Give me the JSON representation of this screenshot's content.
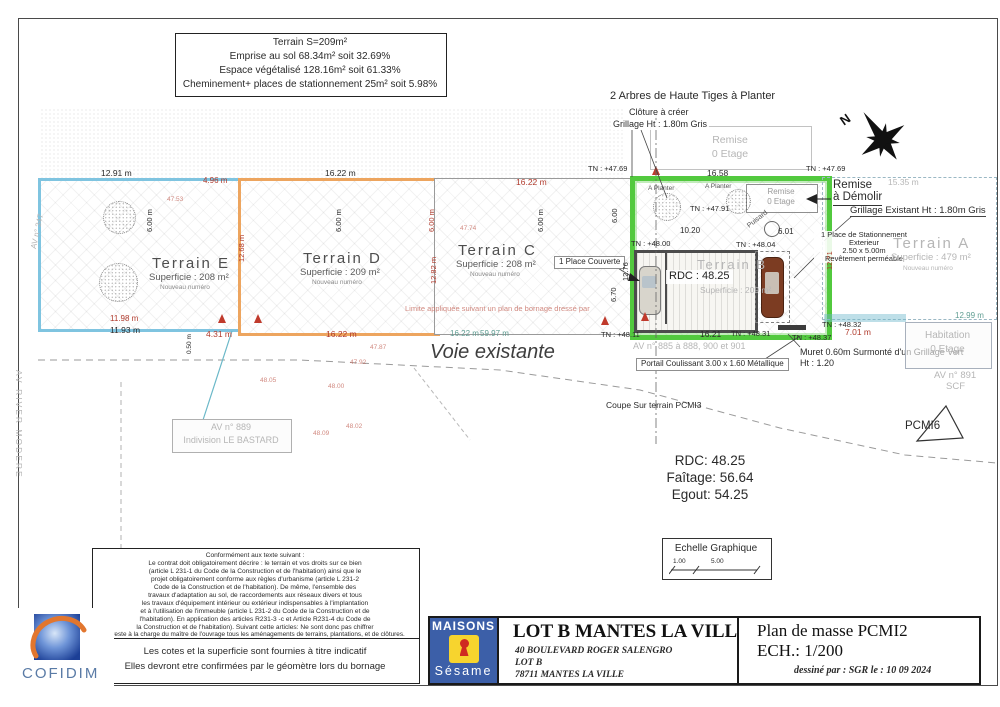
{
  "colors": {
    "lot_b_green": "#52c93e",
    "parcel_e_blue": "#7fc4e0",
    "parcel_d_orange": "#eda55f",
    "marker_red": "#c03a2c",
    "maisons_blue": "#3c5fa8",
    "maisons_yellow": "#f7d42e",
    "keyhole_red": "#cf2a21",
    "cofidim_orange": "#e2762e"
  },
  "stats_box": {
    "lines": [
      "Terrain S=209m²",
      "Emprise au sol 68.34m² soit 32.69%",
      "Espace végétalisé 128.16m² soit  61.33%",
      "Cheminement+ places de stationnement 25m² soit  5.98%"
    ]
  },
  "compass": {
    "label": "N"
  },
  "plan": {
    "terrains": {
      "e": {
        "name": "Terrain E",
        "area": "Superficie : 208 m²",
        "note": "Nouveau numéro"
      },
      "d": {
        "name": "Terrain D",
        "area": "Superficie : 209 m²",
        "note": "Nouveau numéro"
      },
      "c": {
        "name": "Terrain C",
        "area": "Superficie : 208 m²",
        "note": "Nouveau numéro"
      },
      "b": {
        "name": "Terrain B",
        "area": "Superficie : 209 m²",
        "rdc": "RDC : 48.25"
      },
      "a": {
        "name": "Terrain A",
        "area": "Superficie : 479 m²",
        "note": "Nouveau numéro"
      }
    },
    "annotations": {
      "arbres": "2 Arbres de Haute Tiges à Planter",
      "cloture1": "Clôture à créer",
      "cloture2": "Grillage Ht : 1.80m Gris",
      "remise_haut": [
        "Remise",
        "0 Etage"
      ],
      "remise_lot": [
        "Remise",
        "0 Etage"
      ],
      "remise_demolir": [
        "Remise",
        "à Démolir"
      ],
      "grillage_existant": "Grillage Existant Ht : 1.80m Gris",
      "stationnement": [
        "1 Place de Stationnement",
        "Exterieur",
        "2.50 x 5.00m",
        "Revêtement perméable"
      ],
      "place_couverte": "1 Place Couverte",
      "portail": "Portail Coulissant 3.00 x 1.60 Métallique",
      "muret1": "Muret 0.60m Surmonté d'un Grillage Vert",
      "muret2": "Ht : 1.20",
      "coupe": "Coupe Sur terrain PCMI3",
      "pcmi6": "PCMI6",
      "voie": "Voie existante",
      "puisard": "Puisard",
      "a_planter": "A Planter",
      "habitation": [
        "Habitation",
        "0 Etage"
      ],
      "av889": [
        "AV n° 889",
        "Indivision LE BASTARD"
      ],
      "av885": "AV n° 885 à 888, 900 et 901",
      "av891": [
        "AV n° 891",
        "SCF"
      ],
      "av347": "AV n° 347",
      "river": "AV RIVER MODERE",
      "limite": "Limite appliquée suivant un plan de bornage dressé par"
    },
    "dims": {
      "e_top": "12.91 m",
      "e_topright": "4.96 m",
      "e_left": "6.00 m",
      "e_right": "12.68 m",
      "e_bottom_red": "11.98 m",
      "e_bottom": "11.93 m",
      "e_431": "4.31 m",
      "e_050": "0.50 m",
      "d_top": "16.22 m",
      "d_mid": "6.00 m",
      "d_right_a": "6.00 m",
      "d_right": "12.82 m",
      "d_bottom": "16.22 m",
      "c_top": "16.22 m",
      "c_mid": "6.00 m",
      "c_right_a": "6.00",
      "c_right": "12.76",
      "c_670": "6.70",
      "c_bottom": "16.22 m",
      "c_5997": "59.97 m",
      "b_top": "16.58",
      "b_1020": "10.20",
      "b_601": "6.01",
      "b_right": "12.71",
      "b_bottom": "16.21",
      "a_1535": "15.35 m",
      "a_701": "7.01 m",
      "a_1299": "12.99 m"
    },
    "tn": {
      "t4769l": "TN : +47.69",
      "t4769r": "TN : +47.69",
      "t4791": "TN : +47.91",
      "t4800": "TN : +48.00",
      "t4804": "TN : +48.04",
      "t4811": "TN : +48.11",
      "t4831": "TN : +48.31",
      "t4837": "TN : +48.37",
      "t4832": "TN : +48.32"
    },
    "faint_levels": [
      "47.53",
      "47.74",
      "47.87",
      "47.92",
      "48.00",
      "48.05",
      "48.02",
      "48.09"
    ]
  },
  "levels_box": {
    "rdc": "RDC: 48.25",
    "faitage": "Faîtage: 56.64",
    "egout": "Egout: 54.25"
  },
  "scale_box": {
    "title": "Echelle Graphique",
    "tick1": "1.00",
    "tick2": "5.00"
  },
  "legal_box": {
    "lines": [
      "Conformément aux texte suivant :",
      "Le contrat doit obligatoirement décrire : le terrain et vos droits sur ce bien",
      "(article L 231-1 du Code de la Construction et de l'habitation) ainsi que le",
      "projet obligatoirement conforme aux règles d'urbanisme (article L 231-2",
      "Code de la Construction et de l'habitation). De même, l'ensemble des",
      "travaux d'adaptation au sol, de raccordements aux réseaux divers et tous",
      "les travaux d'équipement intérieur ou extérieur indispensables à l'implantation",
      "et à l'utilisation de l'immeuble (article L 231-2 du Code de la Construction et de",
      "l'habitation). En application des articles R231-3 -c et Article R231-4 du Code de",
      "la Construction et de l'habitation). Suivant cette articles: Ne sont donc pas chiffrer",
      "et reste à la charge du maître de l'ouvrage tous les aménagements de terrains, plantations, et de clôtures."
    ]
  },
  "notes_box": {
    "lines": [
      "Les cotes  et la superficie  sont fournies à titre indicatif",
      "Elles devront etre confirmées par le géomètre lors du bornage"
    ]
  },
  "title_block": {
    "maisons": {
      "top": "MAISONS",
      "bottom": "Sésame"
    },
    "project": {
      "title": "LOT B MANTES LA VILLE",
      "address": "40 BOULEVARD ROGER SALENGRO",
      "lot": "LOT B",
      "city": "78711 MANTES LA VILLE"
    },
    "plan": {
      "title": "Plan de masse PCMI2",
      "scale": "ECH.: 1/200",
      "credit": "dessiné par : SGR le : 10 09 2024"
    },
    "cofidim": "COFIDIM"
  }
}
